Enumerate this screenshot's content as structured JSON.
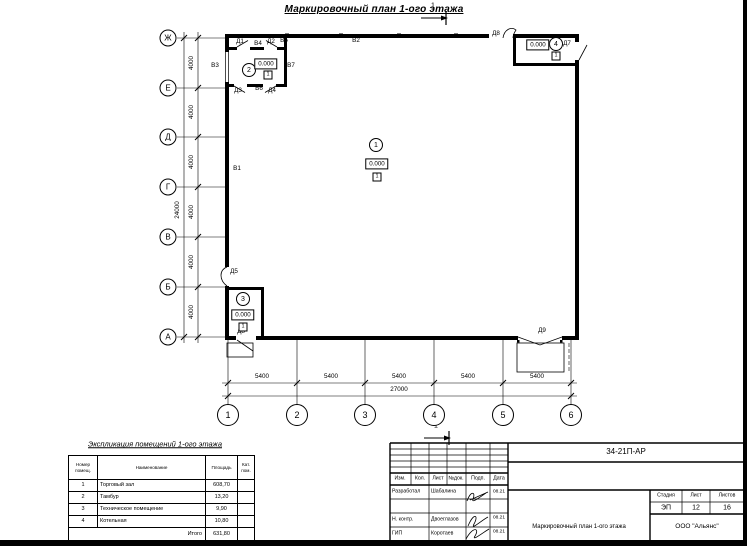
{
  "sheet": {
    "title": "Маркировочный план 1-ого этажа",
    "section_mark": "1"
  },
  "plan": {
    "row_axes": [
      "Ж",
      "Е",
      "Д",
      "Г",
      "В",
      "Б",
      "А"
    ],
    "col_axes": [
      "1",
      "2",
      "3",
      "4",
      "5",
      "6"
    ],
    "dims": {
      "bay_h": "4000",
      "total_h": "24000",
      "bay_w": "5400",
      "total_w": "27000"
    },
    "elevation": "0.000",
    "floor_mark": "1",
    "room_tags": [
      "1",
      "2",
      "3",
      "4"
    ],
    "marks": {
      "v1": "В1",
      "v2": "В2",
      "v3": "В3",
      "v4": "В4",
      "v5": "В5",
      "v6": "В6",
      "v7": "В7",
      "d1": "Д1",
      "d2": "Д2",
      "d3": "Д3",
      "d4": "Д4",
      "d5": "Д5",
      "d7": "Д7",
      "d8_top": "Д8",
      "d8_bottom": "Д8",
      "d9": "Д9"
    }
  },
  "explication": {
    "title": "Экспликация помещений 1-ого этажа",
    "headers": {
      "num": "Номер помещ.",
      "name": "Наименование",
      "area": "Площадь",
      "cat": "Кат. пом."
    },
    "rows": [
      {
        "num": "1",
        "name": "Торговый зал",
        "area": "608,70",
        "cat": ""
      },
      {
        "num": "2",
        "name": "Тамбур",
        "area": "13,20",
        "cat": ""
      },
      {
        "num": "3",
        "name": "Техническое помещение",
        "area": "9,90",
        "cat": ""
      },
      {
        "num": "4",
        "name": "Котельная",
        "area": "10,80",
        "cat": ""
      }
    ],
    "total_label": "Итого",
    "total_area": "631,80"
  },
  "titleblock": {
    "doc_number": "34-21П-АР",
    "cols": {
      "izm": "Изм.",
      "kol": "Кол.",
      "list": "Лист",
      "ndok": "№док.",
      "podp": "Подп.",
      "data": "Дата"
    },
    "rows": [
      {
        "role": "Разработал",
        "name": "Шабалина",
        "date": "08.21"
      },
      {
        "role": "Н. контр.",
        "name": "Двоеглазов",
        "date": "08.21"
      },
      {
        "role": "ГИП",
        "name": "Коротаев",
        "date": "08.21"
      }
    ],
    "stage_label": "Стадия",
    "sheet_label": "Лист",
    "sheets_label": "Листов",
    "stage": "ЭП",
    "sheet_no": "12",
    "sheets_total": "16",
    "drawing_name": "Маркировочный план 1-ого этажа",
    "company": "ООО \"Альянс\""
  }
}
